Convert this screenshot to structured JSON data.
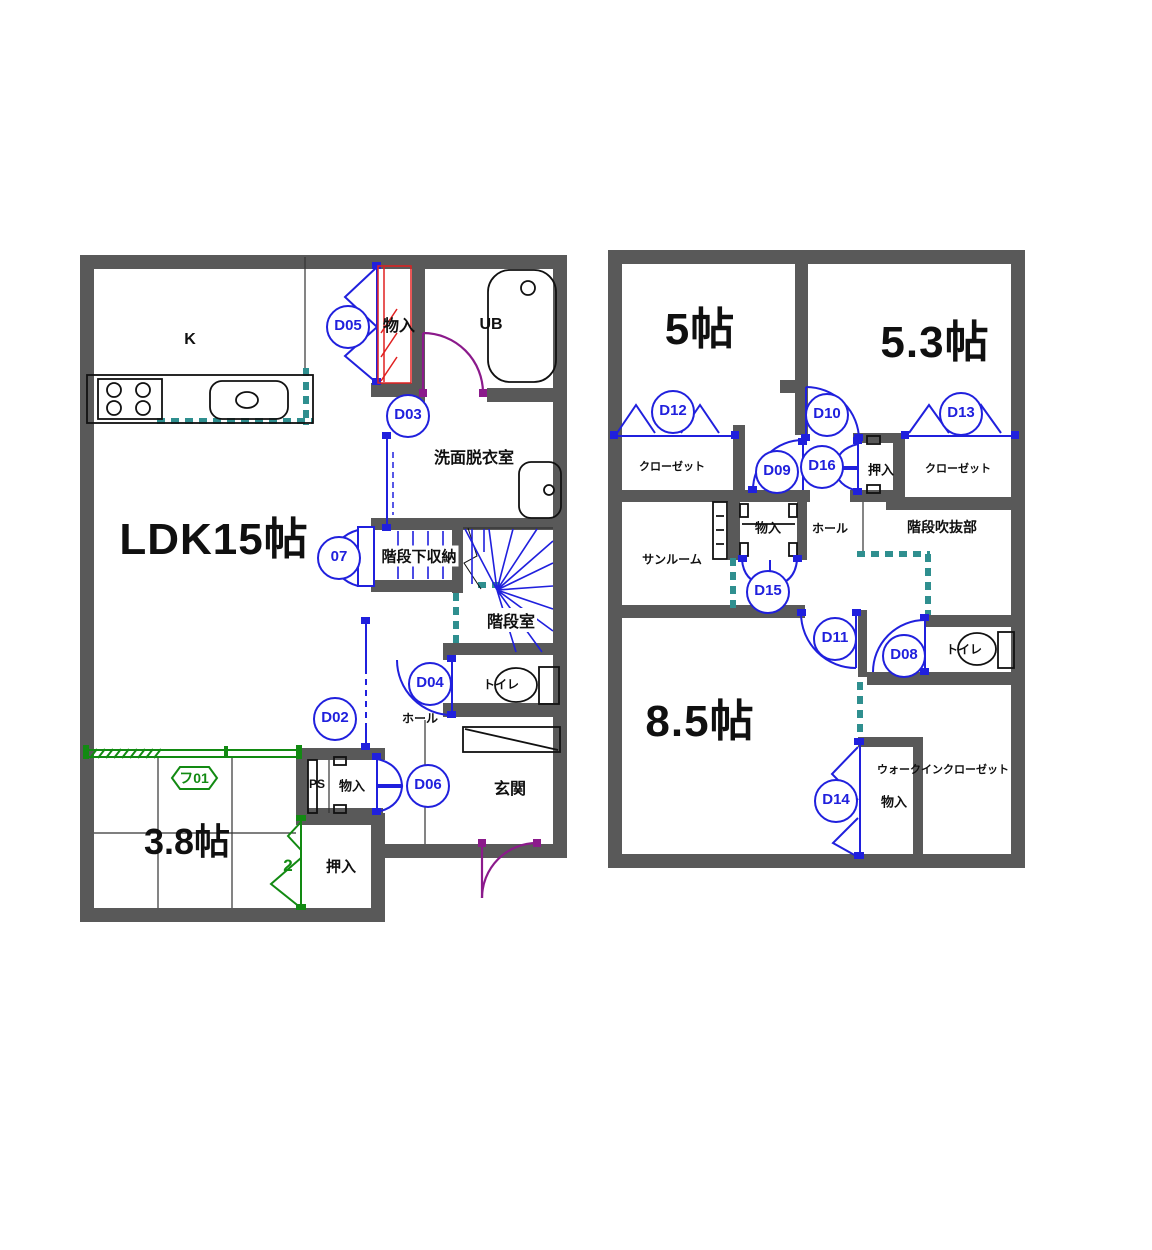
{
  "f1": {
    "rooms": {
      "ldk": "LDK15帖",
      "kitchen": "K",
      "bath": "UB",
      "closet_top": "物入",
      "washroom": "洗面脱衣室",
      "understair": "階段下収納",
      "stairwell": "階段室",
      "hall": "ホール",
      "toilet": "トイレ",
      "entrance": "玄関",
      "ps": "PS",
      "closet_low": "物入",
      "oshiire": "押入",
      "tatami": "3.8帖",
      "tatami_note": "2"
    },
    "doors": {
      "d02": "D02",
      "d03": "D03",
      "d04": "D04",
      "d05": "D05",
      "d06": "D06",
      "d07": "07",
      "f01": "フ01"
    }
  },
  "f2": {
    "rooms": {
      "r5": "5帖",
      "r53": "5.3帖",
      "r85": "8.5帖",
      "closet_l": "クローゼット",
      "closet_r": "クローゼット",
      "oshiire": "押入",
      "sunroom": "サンルーム",
      "closet_mid": "物入",
      "hall": "ホール",
      "stair_void": "階段吹抜部",
      "toilet": "トイレ",
      "wic": "ウォークインクローゼット",
      "wic_closet": "物入"
    },
    "doors": {
      "d08": "D08",
      "d09": "D09",
      "d10": "D10",
      "d11": "D11",
      "d12": "D12",
      "d13": "D13",
      "d14": "D14",
      "d15": "D15",
      "d16": "D16"
    }
  },
  "colors": {
    "wall": "#595959",
    "door_blue": "#2020dd",
    "door_purple": "#8b1a8b",
    "fusuma_green": "#128a12",
    "opening_teal": "#2f8f8f",
    "hatch_red": "#e02020",
    "text": "#101010"
  }
}
